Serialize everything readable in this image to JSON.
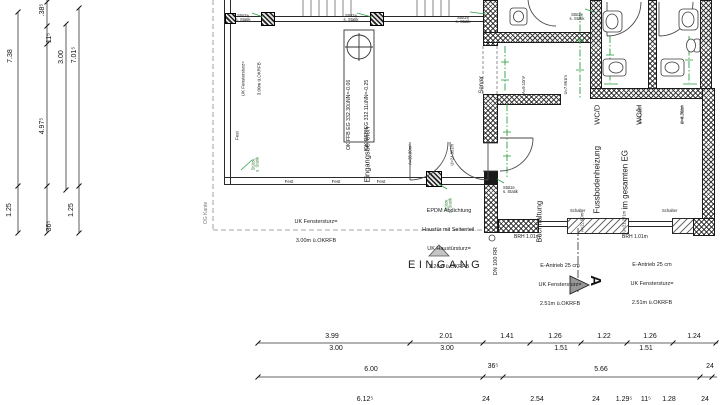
{
  "rooms": {
    "eingang": {
      "name": "Eingangsbereich",
      "area": "A=35.80m²",
      "u": "U=24.951m"
    },
    "server": {
      "name": "Server",
      "area": "A=9.10m²",
      "u": "U=7.961m"
    },
    "wcd": {
      "name": "WC/D",
      "area": "A=4.70m²",
      "u": "U=8.391m"
    },
    "wch": {
      "name": "WC/H",
      "area": "A=4.70m²",
      "u": "U=8.361m"
    },
    "buch": {
      "name": "Buchhaltung",
      "area": "A=22.90m²",
      "u": "U=21.271m"
    }
  },
  "notes": {
    "level1": "OK FFB EG 332.30üNN=-0.06",
    "level2": "OK RFB EG 332.11üNN=-0.25",
    "heating1": "Fussbodenheizung",
    "heating2": "im gesamten EG",
    "fenstersturz1": "UK Fenstersturz=",
    "fenstersturz2": "3.00m ü.OKRFB",
    "epdm1": "EPDM Abdichtung",
    "epdm2": "Haustür mit Seitenteil.",
    "epdm3": "UK Haustürsturz=",
    "epdm4": "2.26m ü.OKRFB",
    "eantrieb1": "E-Antrieb 25 cm",
    "eantrieb2": "UK Fenstersturz=",
    "eantrieb3": "2.51m ü.OKRFB",
    "brh": "BRH 1.01m",
    "rainpipe": "DN 100 RR",
    "og_kante": "OG Kante",
    "fest": "Fest",
    "stuetze1": "Stütze",
    "stuetze2": "s. Statik",
    "schalter": "Schalter",
    "entrance": "EINGANG",
    "section_letter": "A"
  },
  "dims": {
    "left": {
      "a": "7.38",
      "b": ".38⁵",
      "c": "11⁵",
      "d": "3.00",
      "e": "7.01⁵",
      "f": "4.97⁵",
      "g": "36⁵",
      "h": "1.25",
      "i": "1.25"
    },
    "r1": [
      "3.99",
      "2.01",
      "1.41",
      "1.26",
      "1.22",
      "1.26",
      "1.24"
    ],
    "r1b": [
      "3.00",
      "3.00",
      "1.51",
      "1.51"
    ],
    "r2": [
      "6.00",
      "36⁵",
      "5.66",
      "24"
    ],
    "r3": [
      "6.12⁵",
      "24",
      "2.54",
      "24",
      "1.29⁵",
      "11⁵",
      "1.28",
      "24"
    ]
  },
  "colors": {
    "heating_green": "#2f9e44",
    "line": "#1b1b1b"
  }
}
